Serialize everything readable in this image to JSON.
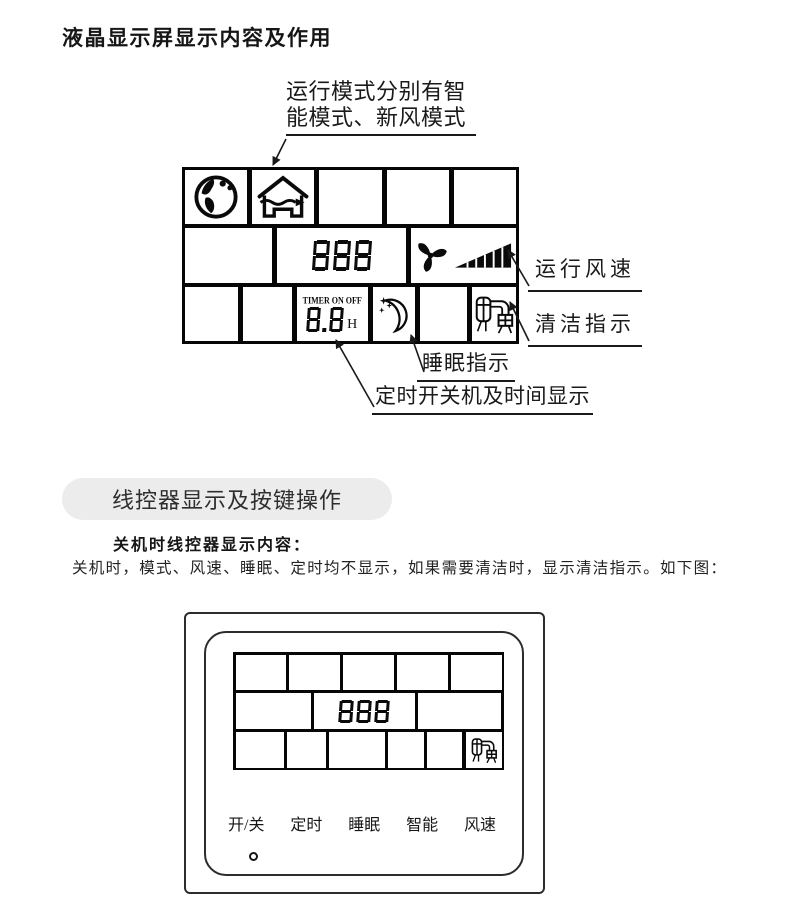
{
  "title": "液晶显示屏显示内容及作用",
  "colors": {
    "ink": "#111111",
    "lcd_border": "#060606",
    "pill_bg": "#ececec"
  },
  "diagram1": {
    "mode_note_line1": "运行模式分别有智",
    "mode_note_line2": "能模式、新风模式",
    "labels": {
      "fan_speed": "运行风速",
      "clean": "清洁指示",
      "sleep": "睡眠指示",
      "timer": "定时开关机及时间显示"
    },
    "lcd": {
      "main_value": "888",
      "timer_caption": "TIMER ON OFF",
      "timer_value": "8.8",
      "timer_unit": "H"
    },
    "icons": {
      "mode_smart": "globe-icon",
      "mode_fresh_air": "house-wave-icon",
      "fan": "fan-icon",
      "speed_level": "speed-wedge-icon",
      "sleep": "moon-stars-icon",
      "clean": "vacuum-clean-icon"
    }
  },
  "section": {
    "header": "线控器显示及按键操作",
    "subheading": "关机时线控器显示内容：",
    "body": "关机时，模式、风速、睡眠、定时均不显示，如果需要清洁时，显示清洁指示。如下图："
  },
  "controller": {
    "lcd_value": "888",
    "buttons": [
      {
        "label": "开/关"
      },
      {
        "label": "定时"
      },
      {
        "label": "睡眠"
      },
      {
        "label": "智能"
      },
      {
        "label": "风速"
      }
    ],
    "indicator": "power-indicator-dot"
  }
}
